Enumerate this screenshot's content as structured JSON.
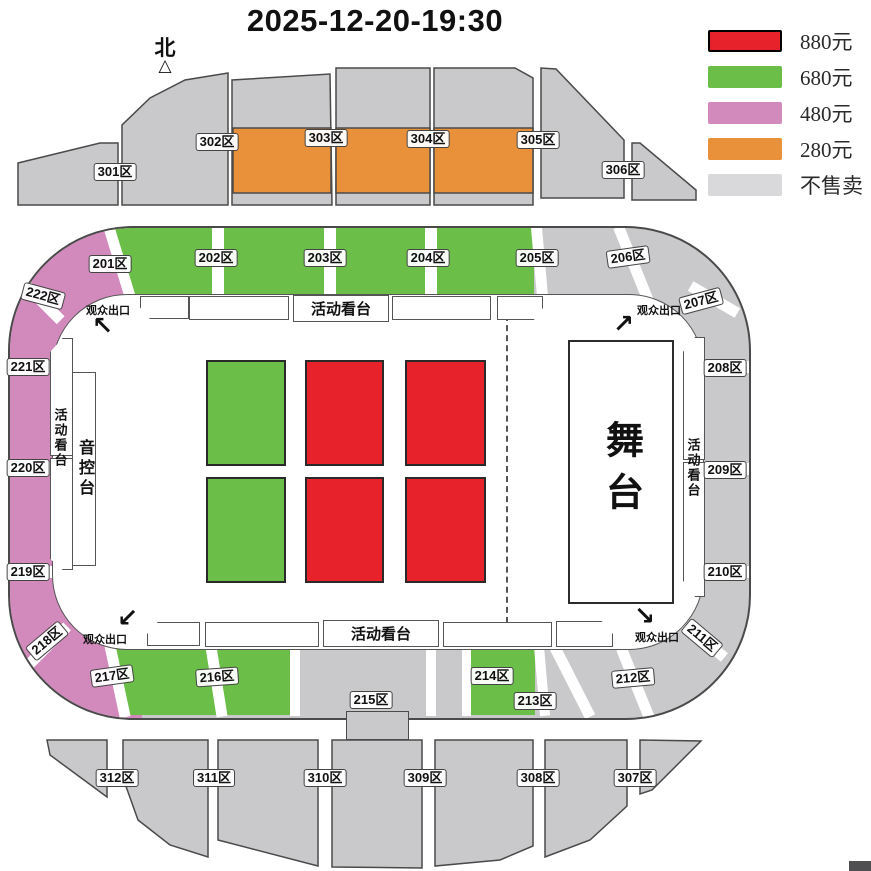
{
  "title": "2025-12-20-19:30",
  "compass": {
    "label": "北",
    "icon": "△"
  },
  "legend": [
    {
      "label": "880元",
      "color": "#e8222b"
    },
    {
      "label": "680元",
      "color": "#6bbf48"
    },
    {
      "label": "480元",
      "color": "#d28abc"
    },
    {
      "label": "280元",
      "color": "#e9903a"
    },
    {
      "label": "不售卖",
      "color": "#d9d9db"
    }
  ],
  "colors": {
    "red": "#e8222b",
    "green": "#6bbf48",
    "pink": "#d28abc",
    "orange": "#e9903a",
    "gray": "#c9c9cb",
    "outline": "#4a4a4a"
  },
  "stage": {
    "label": "舞台"
  },
  "sound_console": {
    "label": "音控台"
  },
  "stands": {
    "label": "活动看台"
  },
  "exits": {
    "label": "观众出口",
    "arrows": {
      "tl": "↖",
      "tr": "↗",
      "bl": "↙",
      "br": "↘"
    }
  },
  "sections": {
    "tier300_top": [
      "301区",
      "302区",
      "303区",
      "304区",
      "305区",
      "306区"
    ],
    "ring200": [
      "201区",
      "202区",
      "203区",
      "204区",
      "205区",
      "206区",
      "207区",
      "208区",
      "209区",
      "210区",
      "211区",
      "212区",
      "213区",
      "214区",
      "215区",
      "216区",
      "217区",
      "218区",
      "219区",
      "220区",
      "221区",
      "222区"
    ],
    "tier300_bottom": [
      "307区",
      "308区",
      "309区",
      "310区",
      "311区",
      "312区"
    ]
  }
}
